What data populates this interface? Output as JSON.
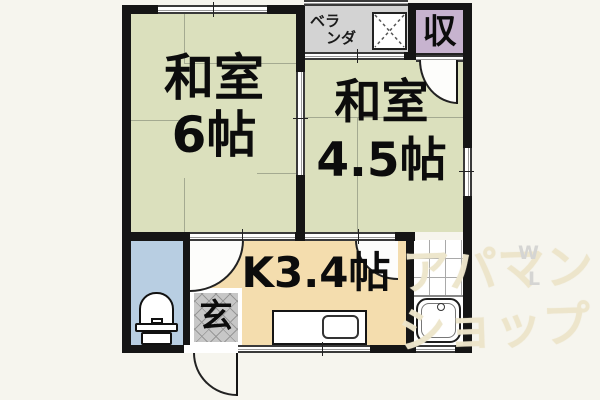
{
  "rooms": {
    "washitsu6": {
      "line1": "和室",
      "line2": "6帖"
    },
    "washitsu45": {
      "line1": "和室",
      "line2": "4.5帖"
    },
    "kitchen": {
      "label": "K3.4帖"
    },
    "veranda": {
      "line1": "ベラ",
      "line2": "ンダ"
    },
    "storage": {
      "label": "収"
    },
    "entrance": {
      "label": "玄"
    }
  },
  "watermark": {
    "line1": "アパマン",
    "line2": "ショップ",
    "letter_top": "W",
    "letter_bottom": "L"
  },
  "colors": {
    "tatami": "#dbe0bd",
    "kitchen_floor": "#f4ddae",
    "toilet_room": "#b8cee2",
    "veranda": "#d3d3d3",
    "storage": "#c7b3cf",
    "entrance_tile": "#c7c7c7",
    "wall": "#151515",
    "page_background": "#f6f5ee",
    "watermark": "#ece5ca"
  }
}
